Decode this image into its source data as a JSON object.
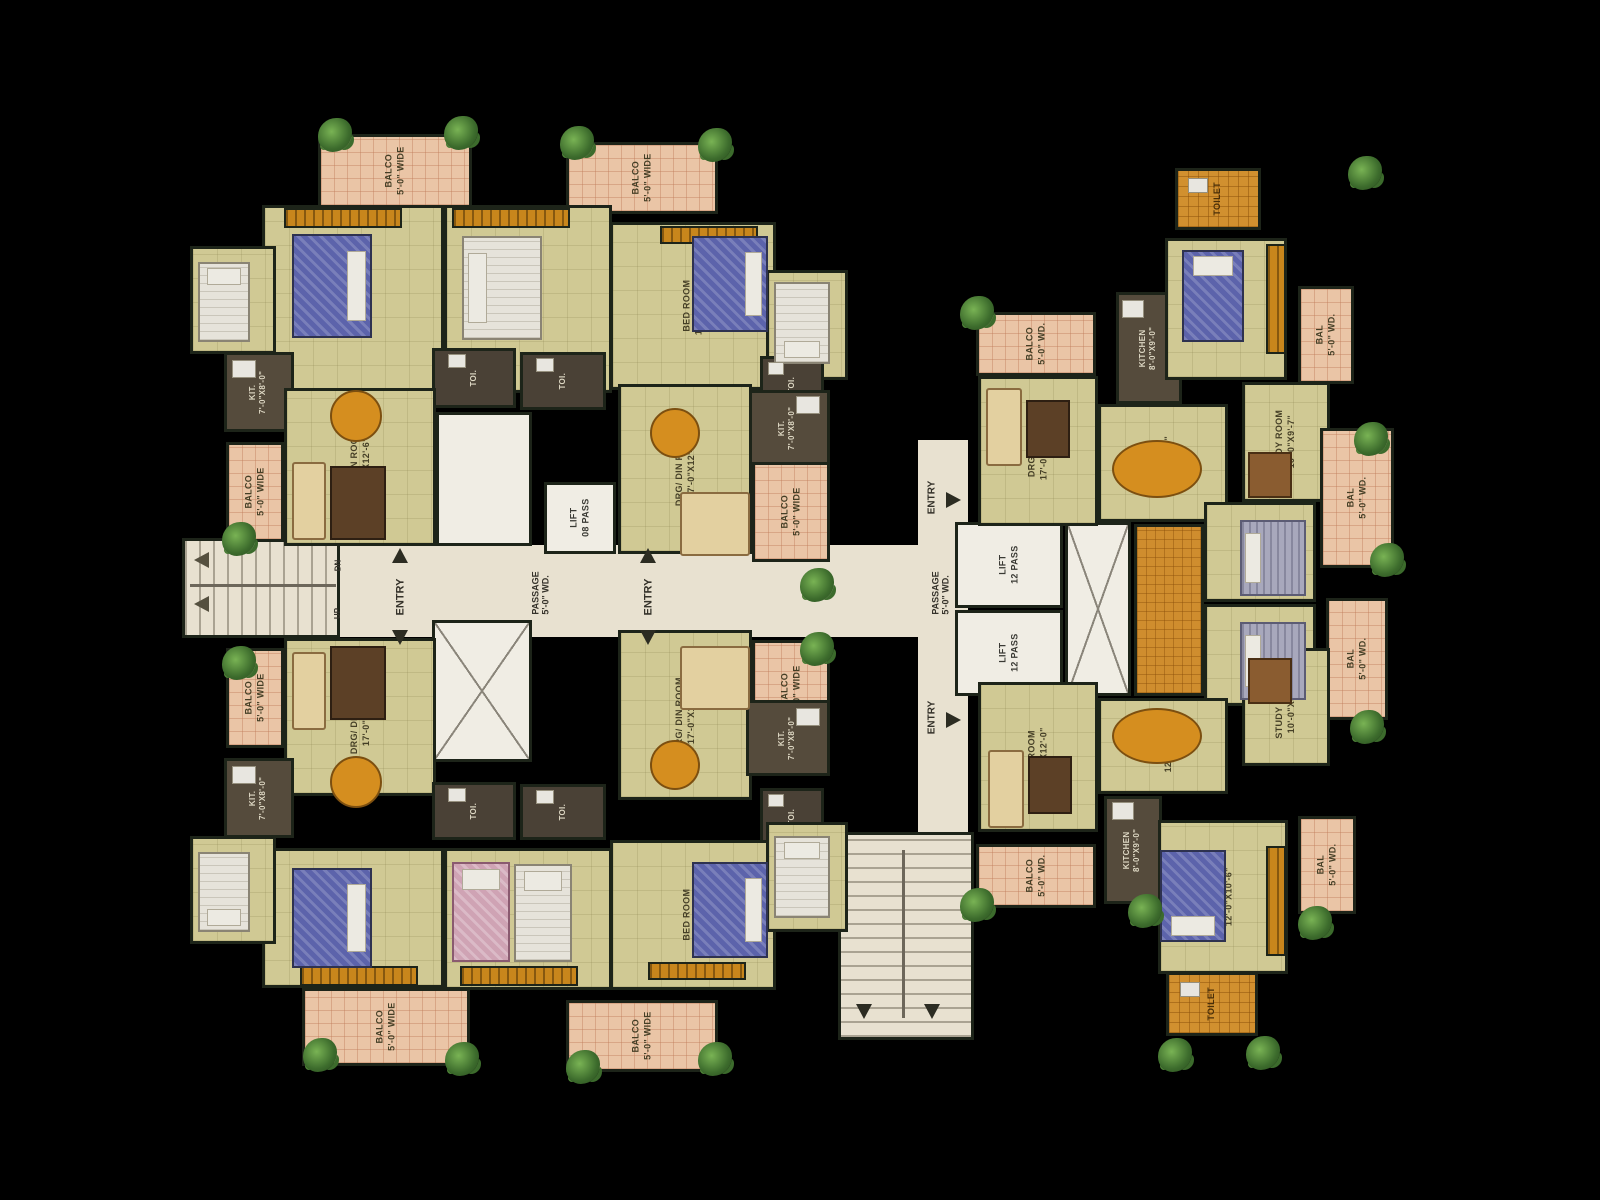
{
  "canvas": {
    "width": 1600,
    "height": 1200,
    "background": "#000000"
  },
  "colors": {
    "floor_khaki": "#d0c994",
    "balcony_peach": "#eac5a6",
    "wall_dark": "#1d2419",
    "core_white": "#f0ede4",
    "passage_cream": "#e8e1d0",
    "wardrobe_orange": "#c8861c",
    "toilet_tile_orange": "#d1902f",
    "bed_blue": "#5c63ab",
    "table_orange": "#d58e1f",
    "plant_green": "#3c6b2c"
  },
  "rooms": [
    {
      "id": "passage-main",
      "type": "passage",
      "label": "",
      "x": 338,
      "y": 545,
      "w": 630,
      "h": 92
    },
    {
      "id": "passage-b-vertical",
      "type": "passage",
      "label": "",
      "x": 918,
      "y": 440,
      "w": 50,
      "h": 400
    },
    {
      "id": "stair-left",
      "type": "stairh",
      "label": "",
      "x": 182,
      "y": 538,
      "w": 158,
      "h": 100
    },
    {
      "id": "stair-bottom",
      "type": "stairv",
      "label": "",
      "x": 838,
      "y": 832,
      "w": 136,
      "h": 208
    },
    {
      "id": "hall-core-a",
      "type": "white",
      "label": "",
      "x": 436,
      "y": 412,
      "w": 96,
      "h": 134
    },
    {
      "id": "shaft-core-a",
      "type": "shaft",
      "label": "",
      "x": 432,
      "y": 620,
      "w": 100,
      "h": 142
    },
    {
      "id": "lift-a",
      "type": "lift",
      "label": "LIFT\n08 PASS",
      "x": 544,
      "y": 482,
      "w": 72,
      "h": 72
    },
    {
      "id": "lift-b1",
      "type": "lift",
      "label": "LIFT\n12 PASS",
      "x": 955,
      "y": 522,
      "w": 108,
      "h": 86
    },
    {
      "id": "lift-b2",
      "type": "lift",
      "label": "LIFT\n12 PASS",
      "x": 955,
      "y": 610,
      "w": 108,
      "h": 86
    },
    {
      "id": "shaft-core-b",
      "type": "shaft",
      "label": "",
      "x": 1065,
      "y": 522,
      "w": 66,
      "h": 174
    },
    {
      "id": "balco-tl-top",
      "type": "balcony",
      "label": "BALCO\n5'-0\" WIDE",
      "x": 318,
      "y": 134,
      "w": 154,
      "h": 74
    },
    {
      "id": "balco-tr-top",
      "type": "balcony",
      "label": "BALCO\n5'-0\" WIDE",
      "x": 566,
      "y": 142,
      "w": 152,
      "h": 72
    },
    {
      "id": "bedroom-tl-1",
      "type": "room",
      "label": "BED ROOM\n12'-6\"X11'-0\"",
      "x": 262,
      "y": 205,
      "w": 182,
      "h": 188
    },
    {
      "id": "bedroom-tl-2",
      "type": "room",
      "label": "BED ROOM\n12'-0\"X12'-6\"",
      "x": 444,
      "y": 205,
      "w": 168,
      "h": 188
    },
    {
      "id": "bedroom-tr-1",
      "type": "room",
      "label": "BED ROOM\n12'-0\"X12'-6\"",
      "x": 610,
      "y": 222,
      "w": 166,
      "h": 168
    },
    {
      "id": "bedroom-edge-left-top",
      "type": "room",
      "label": "BED ROOM",
      "x": 190,
      "y": 246,
      "w": 86,
      "h": 108
    },
    {
      "id": "bedroom-edge-right-top",
      "type": "room",
      "label": "BED ROOM",
      "x": 766,
      "y": 270,
      "w": 82,
      "h": 110
    },
    {
      "id": "kitchen-tl",
      "type": "kitchen",
      "label": "KIT.\n7'-0\"X8'-0\"",
      "x": 224,
      "y": 352,
      "w": 70,
      "h": 80
    },
    {
      "id": "toilet-center-1",
      "type": "toidark",
      "label": "TOI.",
      "x": 432,
      "y": 348,
      "w": 84,
      "h": 60
    },
    {
      "id": "toilet-center-2",
      "type": "toidark",
      "label": "TOI.",
      "x": 520,
      "y": 352,
      "w": 86,
      "h": 58
    },
    {
      "id": "toilet-right-top",
      "type": "toidark",
      "label": "TOI.",
      "x": 760,
      "y": 356,
      "w": 64,
      "h": 58
    },
    {
      "id": "kitchen-tr",
      "type": "kitchen",
      "label": "KIT.\n7'-0\"X8'-0\"",
      "x": 746,
      "y": 390,
      "w": 84,
      "h": 76
    },
    {
      "id": "balco-left-top",
      "type": "balcony",
      "label": "BALCO\n5'-0\" WIDE",
      "x": 226,
      "y": 442,
      "w": 58,
      "h": 100
    },
    {
      "id": "drg-din-tl",
      "type": "room",
      "label": "DRG/ DIN ROOM\n17'-0\"X12'-6\"",
      "x": 284,
      "y": 388,
      "w": 152,
      "h": 158
    },
    {
      "id": "drg-din-tr",
      "type": "room",
      "label": "DRG/ DIN ROOM\n17'-0\"X12'-6\"",
      "x": 618,
      "y": 384,
      "w": 134,
      "h": 170
    },
    {
      "id": "balco-right-top",
      "type": "balcony",
      "label": "BALCO\n5'-0\" WIDE",
      "x": 752,
      "y": 462,
      "w": 78,
      "h": 100
    },
    {
      "id": "balco-left-bottom",
      "type": "balcony",
      "label": "BALCO\n5'-0\" WIDE",
      "x": 226,
      "y": 648,
      "w": 58,
      "h": 100
    },
    {
      "id": "drg-din-bl",
      "type": "room",
      "label": "DRG/ DIN ROOM\n17'-0\"X12'-6\"",
      "x": 284,
      "y": 638,
      "w": 152,
      "h": 158
    },
    {
      "id": "drg-din-br",
      "type": "room",
      "label": "DRG/ DIN ROOM\n17'-0\"X12'-6\"",
      "x": 618,
      "y": 630,
      "w": 134,
      "h": 170
    },
    {
      "id": "balco-right-bottom",
      "type": "balcony",
      "label": "BALCO\n5'-0\" WIDE",
      "x": 752,
      "y": 640,
      "w": 78,
      "h": 100
    },
    {
      "id": "kitchen-bl",
      "type": "kitchen",
      "label": "KIT.\n7'-0\"X8'-0\"",
      "x": 224,
      "y": 758,
      "w": 70,
      "h": 80
    },
    {
      "id": "toilet-center-3",
      "type": "toidark",
      "label": "TOI.",
      "x": 432,
      "y": 782,
      "w": 84,
      "h": 58
    },
    {
      "id": "toilet-center-4",
      "type": "toidark",
      "label": "TOI.",
      "x": 520,
      "y": 784,
      "w": 86,
      "h": 56
    },
    {
      "id": "toilet-right-bottom",
      "type": "toidark",
      "label": "TOI.",
      "x": 760,
      "y": 788,
      "w": 64,
      "h": 58
    },
    {
      "id": "kitchen-br",
      "type": "kitchen",
      "label": "KIT.\n7'-0\"X8'-0\"",
      "x": 746,
      "y": 700,
      "w": 84,
      "h": 76
    },
    {
      "id": "bedroom-bl-1",
      "type": "room",
      "label": "BED ROOM\n12'-0\"X10'-6\"",
      "x": 262,
      "y": 848,
      "w": 182,
      "h": 140
    },
    {
      "id": "bedroom-bl-2",
      "type": "room",
      "label": "BED ROOM\n17'-0\"X11'-0\"",
      "x": 444,
      "y": 848,
      "w": 168,
      "h": 142
    },
    {
      "id": "bedroom-br-1",
      "type": "room",
      "label": "BED ROOM\n12'-0\"X12'-6\"",
      "x": 610,
      "y": 840,
      "w": 166,
      "h": 150
    },
    {
      "id": "bedroom-edge-left-bottom",
      "type": "room",
      "label": "BED ROOM",
      "x": 190,
      "y": 836,
      "w": 86,
      "h": 108
    },
    {
      "id": "bedroom-edge-right-bottom",
      "type": "room",
      "label": "BED ROOM",
      "x": 766,
      "y": 822,
      "w": 82,
      "h": 110
    },
    {
      "id": "balco-bl-bottom",
      "type": "balcony",
      "label": "BALCO\n5'-0\" WIDE",
      "x": 302,
      "y": 988,
      "w": 168,
      "h": 78
    },
    {
      "id": "balco-br-bottom",
      "type": "balcony",
      "label": "BALCO\n5'-0\" WIDE",
      "x": 566,
      "y": 1000,
      "w": 152,
      "h": 72
    },
    {
      "id": "balco-b-topleft",
      "type": "balcony",
      "label": "BALCO\n5'-0\" WD.",
      "x": 976,
      "y": 312,
      "w": 120,
      "h": 64
    },
    {
      "id": "drg-room-b-top",
      "type": "room",
      "label": "DRG ROOM\n17'-0\"X12'-0\"",
      "x": 978,
      "y": 376,
      "w": 120,
      "h": 150
    },
    {
      "id": "kitchen-b-top",
      "type": "kitchen",
      "label": "KITCHEN\n8'-0\"X9'-0\"",
      "x": 1116,
      "y": 292,
      "w": 66,
      "h": 112
    },
    {
      "id": "dining-b-top",
      "type": "room",
      "label": "DINING\n12'-0\"X9'-0\"",
      "x": 1098,
      "y": 404,
      "w": 130,
      "h": 118
    },
    {
      "id": "toilet-b-top",
      "type": "toitile",
      "label": "TOILET",
      "x": 1175,
      "y": 168,
      "w": 86,
      "h": 62
    },
    {
      "id": "bedroom-b-topright",
      "type": "room",
      "label": "BED ROOM\n12'-0\"X10'-6\"",
      "x": 1165,
      "y": 238,
      "w": 122,
      "h": 142
    },
    {
      "id": "bal-b-topright",
      "type": "balcony",
      "label": "BAL\n5'-0\" WD.",
      "x": 1298,
      "y": 286,
      "w": 56,
      "h": 98
    },
    {
      "id": "study-room-b-top",
      "type": "room",
      "label": "STUDY ROOM\n10'-0\"X9'-7\"",
      "x": 1242,
      "y": 382,
      "w": 88,
      "h": 120
    },
    {
      "id": "bal-b-right-1",
      "type": "balcony",
      "label": "BAL\n5'-0\" WD.",
      "x": 1320,
      "y": 428,
      "w": 74,
      "h": 140
    },
    {
      "id": "dress-b-mid",
      "type": "dress",
      "label": "",
      "x": 1134,
      "y": 524,
      "w": 70,
      "h": 172
    },
    {
      "id": "bedroom-b-mid-1",
      "type": "room",
      "label": "BED ROOM\n10'-0\"X12'-0\"",
      "x": 1204,
      "y": 502,
      "w": 112,
      "h": 100
    },
    {
      "id": "bedroom-b-mid-2",
      "type": "room",
      "label": "BED ROOM\n10'-0\"X12'-0\"",
      "x": 1204,
      "y": 604,
      "w": 112,
      "h": 102
    },
    {
      "id": "bal-b-right-2",
      "type": "balcony",
      "label": "BAL\n5'-0\" WD.",
      "x": 1326,
      "y": 598,
      "w": 62,
      "h": 122
    },
    {
      "id": "dining-b-bottom",
      "type": "room",
      "label": "DINING\n12'-0\"X9'-0\"",
      "x": 1098,
      "y": 698,
      "w": 130,
      "h": 96
    },
    {
      "id": "drg-room-b-bottom",
      "type": "room",
      "label": "DRG ROOM\n17'-0\"X12'-0\"",
      "x": 978,
      "y": 682,
      "w": 120,
      "h": 150
    },
    {
      "id": "balco-b-bottomleft",
      "type": "balcony",
      "label": "BALCO\n5'-0\" WD.",
      "x": 976,
      "y": 844,
      "w": 120,
      "h": 64
    },
    {
      "id": "kitchen-b-bottom",
      "type": "kitchen",
      "label": "KITCHEN\n8'-0\"X9'-0\"",
      "x": 1104,
      "y": 796,
      "w": 58,
      "h": 108
    },
    {
      "id": "study-room-b-bottom",
      "type": "room",
      "label": "STUDY ROOM\n10'-0\"X9'-7\"",
      "x": 1242,
      "y": 648,
      "w": 88,
      "h": 118
    },
    {
      "id": "bedroom-b-bottomright",
      "type": "room",
      "label": "BED ROOM\n12'-0\"X10'-6\"",
      "x": 1158,
      "y": 820,
      "w": 130,
      "h": 154
    },
    {
      "id": "bal-b-bottomright",
      "type": "balcony",
      "label": "BAL\n5'-0\" WD.",
      "x": 1298,
      "y": 816,
      "w": 58,
      "h": 98
    },
    {
      "id": "toilet-b-bottom",
      "type": "toitile",
      "label": "TOILET",
      "x": 1166,
      "y": 972,
      "w": 92,
      "h": 64
    }
  ],
  "wardrobes": [
    {
      "x": 284,
      "y": 208,
      "w": 118,
      "h": 20
    },
    {
      "x": 452,
      "y": 208,
      "w": 118,
      "h": 20
    },
    {
      "x": 660,
      "y": 226,
      "w": 98,
      "h": 18
    },
    {
      "x": 300,
      "y": 966,
      "w": 118,
      "h": 20
    },
    {
      "x": 460,
      "y": 966,
      "w": 118,
      "h": 20
    },
    {
      "x": 648,
      "y": 962,
      "w": 98,
      "h": 18
    },
    {
      "x": 1266,
      "y": 244,
      "w": 20,
      "h": 110
    },
    {
      "x": 1266,
      "y": 846,
      "w": 20,
      "h": 110
    }
  ],
  "furniture": [
    {
      "kind": "bed-blue",
      "p": "e",
      "x": 292,
      "y": 234,
      "w": 80,
      "h": 104
    },
    {
      "kind": "bed-white",
      "p": "w",
      "x": 462,
      "y": 236,
      "w": 80,
      "h": 104
    },
    {
      "kind": "bed-blue",
      "p": "e",
      "x": 692,
      "y": 236,
      "w": 76,
      "h": 96
    },
    {
      "kind": "bed-white",
      "p": "n",
      "x": 198,
      "y": 262,
      "w": 52,
      "h": 80
    },
    {
      "kind": "bed-white",
      "p": "s",
      "x": 774,
      "y": 282,
      "w": 56,
      "h": 82
    },
    {
      "kind": "bed-blue",
      "p": "e",
      "x": 292,
      "y": 868,
      "w": 80,
      "h": 100
    },
    {
      "kind": "bed-pink",
      "p": "n",
      "x": 452,
      "y": 862,
      "w": 58,
      "h": 100
    },
    {
      "kind": "bed-white",
      "p": "n",
      "x": 514,
      "y": 864,
      "w": 58,
      "h": 98
    },
    {
      "kind": "bed-blue",
      "p": "e",
      "x": 692,
      "y": 862,
      "w": 76,
      "h": 96
    },
    {
      "kind": "bed-white",
      "p": "s",
      "x": 198,
      "y": 852,
      "w": 52,
      "h": 80
    },
    {
      "kind": "bed-white",
      "p": "n",
      "x": 774,
      "y": 836,
      "w": 56,
      "h": 82
    },
    {
      "kind": "bed-blue",
      "p": "n",
      "x": 1182,
      "y": 250,
      "w": 62,
      "h": 92
    },
    {
      "kind": "bed-grey",
      "p": "w",
      "x": 1240,
      "y": 520,
      "w": 66,
      "h": 76
    },
    {
      "kind": "bed-grey",
      "p": "w",
      "x": 1240,
      "y": 622,
      "w": 66,
      "h": 78
    },
    {
      "kind": "bed-blue",
      "p": "s",
      "x": 1160,
      "y": 850,
      "w": 66,
      "h": 92
    },
    {
      "kind": "sofa",
      "x": 292,
      "y": 462,
      "w": 34,
      "h": 78
    },
    {
      "kind": "tv",
      "x": 330,
      "y": 466,
      "w": 56,
      "h": 74
    },
    {
      "kind": "sofa",
      "x": 292,
      "y": 652,
      "w": 34,
      "h": 78
    },
    {
      "kind": "tv",
      "x": 330,
      "y": 646,
      "w": 56,
      "h": 74
    },
    {
      "kind": "sofa",
      "x": 680,
      "y": 492,
      "w": 70,
      "h": 64
    },
    {
      "kind": "sofa",
      "x": 680,
      "y": 646,
      "w": 70,
      "h": 64
    },
    {
      "kind": "sofa",
      "x": 986,
      "y": 388,
      "w": 36,
      "h": 78
    },
    {
      "kind": "tv",
      "x": 1026,
      "y": 400,
      "w": 44,
      "h": 58
    },
    {
      "kind": "sofa",
      "x": 988,
      "y": 750,
      "w": 36,
      "h": 78
    },
    {
      "kind": "tv",
      "x": 1028,
      "y": 756,
      "w": 44,
      "h": 58
    },
    {
      "kind": "table-round",
      "x": 330,
      "y": 390,
      "w": 52,
      "h": 52
    },
    {
      "kind": "table-round",
      "x": 650,
      "y": 408,
      "w": 50,
      "h": 50
    },
    {
      "kind": "table-round",
      "x": 330,
      "y": 756,
      "w": 52,
      "h": 52
    },
    {
      "kind": "table-round",
      "x": 650,
      "y": 740,
      "w": 50,
      "h": 50
    },
    {
      "kind": "table-oval",
      "x": 1112,
      "y": 440,
      "w": 90,
      "h": 58
    },
    {
      "kind": "table-oval",
      "x": 1112,
      "y": 708,
      "w": 90,
      "h": 56
    },
    {
      "kind": "desk",
      "x": 1248,
      "y": 452,
      "w": 44,
      "h": 46
    },
    {
      "kind": "desk",
      "x": 1248,
      "y": 658,
      "w": 44,
      "h": 46
    },
    {
      "kind": "fixture",
      "x": 232,
      "y": 360,
      "w": 24,
      "h": 18
    },
    {
      "kind": "fixture",
      "x": 232,
      "y": 766,
      "w": 24,
      "h": 18
    },
    {
      "kind": "fixture",
      "x": 796,
      "y": 396,
      "w": 24,
      "h": 18
    },
    {
      "kind": "fixture",
      "x": 796,
      "y": 708,
      "w": 24,
      "h": 18
    },
    {
      "kind": "fixture",
      "x": 1122,
      "y": 300,
      "w": 22,
      "h": 18
    },
    {
      "kind": "fixture",
      "x": 1112,
      "y": 802,
      "w": 22,
      "h": 18
    },
    {
      "kind": "fixture",
      "x": 448,
      "y": 354,
      "w": 18,
      "h": 14
    },
    {
      "kind": "fixture",
      "x": 536,
      "y": 358,
      "w": 18,
      "h": 14
    },
    {
      "kind": "fixture",
      "x": 448,
      "y": 788,
      "w": 18,
      "h": 14
    },
    {
      "kind": "fixture",
      "x": 536,
      "y": 790,
      "w": 18,
      "h": 14
    },
    {
      "kind": "fixture",
      "x": 768,
      "y": 362,
      "w": 16,
      "h": 13
    },
    {
      "kind": "fixture",
      "x": 768,
      "y": 794,
      "w": 16,
      "h": 13
    },
    {
      "kind": "fixture",
      "x": 1188,
      "y": 178,
      "w": 20,
      "h": 15
    },
    {
      "kind": "fixture",
      "x": 1180,
      "y": 982,
      "w": 20,
      "h": 15
    }
  ],
  "plants": [
    {
      "x": 318,
      "y": 118
    },
    {
      "x": 444,
      "y": 116
    },
    {
      "x": 560,
      "y": 126
    },
    {
      "x": 698,
      "y": 128
    },
    {
      "x": 222,
      "y": 522
    },
    {
      "x": 222,
      "y": 646
    },
    {
      "x": 303,
      "y": 1038
    },
    {
      "x": 445,
      "y": 1042
    },
    {
      "x": 566,
      "y": 1050
    },
    {
      "x": 698,
      "y": 1042
    },
    {
      "x": 800,
      "y": 568
    },
    {
      "x": 800,
      "y": 632
    },
    {
      "x": 960,
      "y": 296
    },
    {
      "x": 1348,
      "y": 156
    },
    {
      "x": 1354,
      "y": 422
    },
    {
      "x": 1370,
      "y": 543
    },
    {
      "x": 1350,
      "y": 710
    },
    {
      "x": 1298,
      "y": 906
    },
    {
      "x": 1128,
      "y": 894
    },
    {
      "x": 1158,
      "y": 1038
    },
    {
      "x": 1246,
      "y": 1036
    },
    {
      "x": 960,
      "y": 888
    }
  ],
  "notes": [
    {
      "id": "passage-label-a",
      "text": "PASSAGE\n5'-0\" WD.",
      "x": 528,
      "y": 556,
      "w": 26,
      "h": 74,
      "size": 9
    },
    {
      "id": "passage-label-b",
      "text": "PASSAGE\n5'-0\" WD.",
      "x": 928,
      "y": 556,
      "w": 26,
      "h": 74,
      "size": 9
    },
    {
      "id": "entry-left",
      "text": "ENTRY",
      "x": 390,
      "y": 566,
      "w": 20,
      "h": 62,
      "size": 11
    },
    {
      "id": "entry-right",
      "text": "ENTRY",
      "x": 638,
      "y": 566,
      "w": 20,
      "h": 62,
      "size": 11
    },
    {
      "id": "entry-b-top",
      "text": "ENTRY",
      "x": 922,
      "y": 468,
      "w": 20,
      "h": 58,
      "size": 10
    },
    {
      "id": "entry-b-bottom",
      "text": "ENTRY",
      "x": 922,
      "y": 688,
      "w": 20,
      "h": 58,
      "size": 10
    },
    {
      "id": "stair-dn-label",
      "text": "DN",
      "x": 330,
      "y": 552,
      "w": 16,
      "h": 26,
      "size": 8
    },
    {
      "id": "stair-up-label",
      "text": "UP",
      "x": 330,
      "y": 600,
      "w": 16,
      "h": 26,
      "size": 8
    }
  ],
  "arrows": [
    {
      "dir": "up",
      "x": 392,
      "y": 548
    },
    {
      "dir": "down",
      "x": 392,
      "y": 630
    },
    {
      "dir": "up",
      "x": 640,
      "y": 548
    },
    {
      "dir": "down",
      "x": 640,
      "y": 630
    },
    {
      "dir": "right",
      "x": 946,
      "y": 492
    },
    {
      "dir": "right",
      "x": 946,
      "y": 712
    },
    {
      "dir": "left",
      "x": 194,
      "y": 552
    },
    {
      "dir": "left",
      "x": 194,
      "y": 596
    },
    {
      "dir": "down",
      "x": 856,
      "y": 1004
    },
    {
      "dir": "down",
      "x": 924,
      "y": 1004
    }
  ],
  "rails": [
    {
      "x": 190,
      "y": 584,
      "w": 146,
      "h": 3
    },
    {
      "x": 902,
      "y": 850,
      "w": 3,
      "h": 168
    }
  ]
}
